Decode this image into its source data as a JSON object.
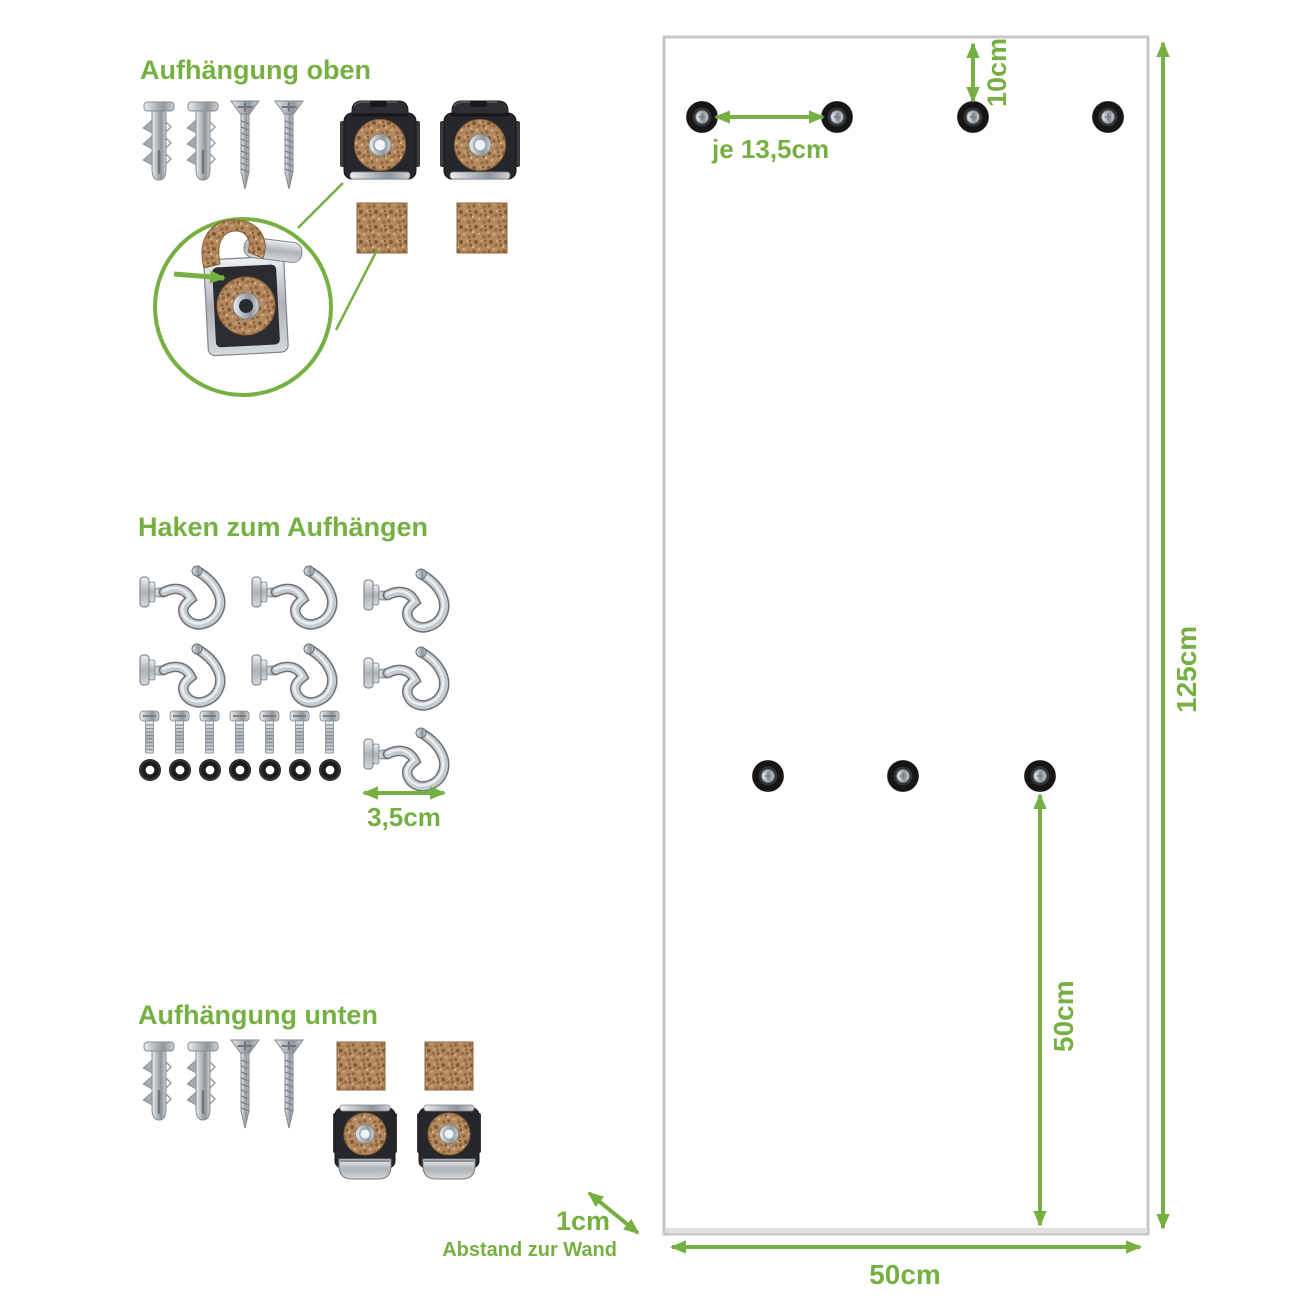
{
  "colors": {
    "accent_green": "#76b043",
    "panel_border": "#c7c7c7",
    "cork_brown": "#b3895f",
    "metal_gray": "#c7cbd0",
    "washer_black": "#1b1c1e"
  },
  "sections": {
    "top_mount": {
      "title": "Aufhängung oben",
      "items": [
        "wall-plug",
        "wall-plug",
        "screw",
        "screw",
        "mounting-clip",
        "mounting-clip",
        "cork-pad",
        "cork-pad"
      ],
      "detail": "clip-with-cork-magnified"
    },
    "hooks": {
      "title": "Haken zum Aufhängen",
      "hook_count": 7,
      "bolt_count": 7,
      "washer_count": 7,
      "screw_spacing_label": "3,5cm"
    },
    "bottom_mount": {
      "title": "Aufhängung unten",
      "items": [
        "wall-plug",
        "wall-plug",
        "screw",
        "screw",
        "cork-pad",
        "cork-pad",
        "mounting-clip",
        "mounting-clip"
      ]
    }
  },
  "panel": {
    "top_hole_count": 4,
    "middle_hole_count": 3,
    "height_label": "125cm",
    "width_label": "50cm",
    "top_edge_to_holes_label": "10cm",
    "top_hole_spacing_label": "je 13,5cm",
    "bottom_hole_height_label": "50cm",
    "wall_gap_label": "1cm",
    "wall_gap_caption": "Abstand zur Wand"
  }
}
